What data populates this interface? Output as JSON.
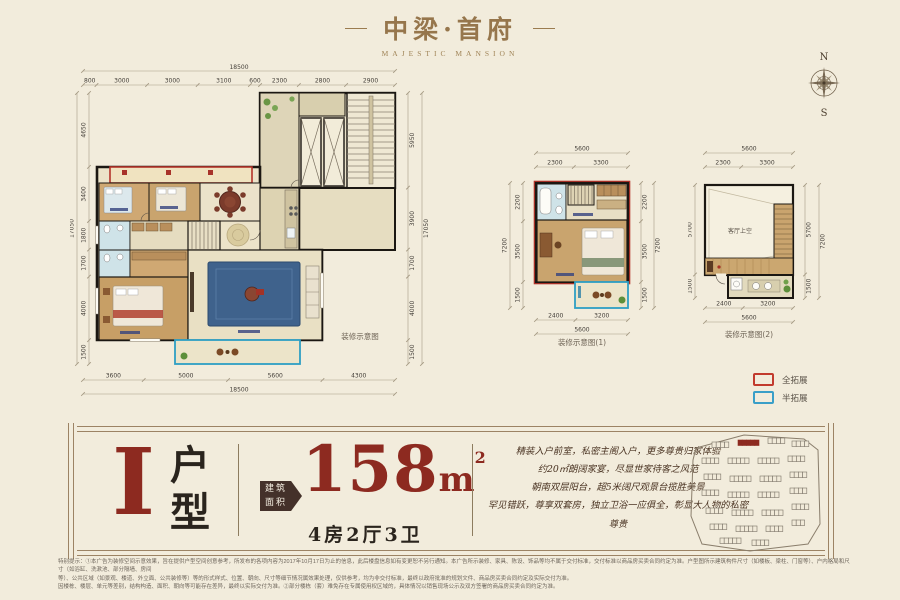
{
  "header": {
    "logo": "中梁·首府",
    "logo_sub": "MAJESTIC MANSION"
  },
  "compass": {
    "north": "N",
    "south": "S"
  },
  "main_plan": {
    "caption": "装修示意图",
    "dim_top_total": "18500",
    "dims_top": [
      "800",
      "3000",
      "3000",
      "3100",
      "600",
      "2300",
      "2800",
      "2900"
    ],
    "dim_left_total": "17050",
    "dims_left": [
      "4650",
      "3400",
      "1800",
      "1700",
      "4000",
      "1500"
    ],
    "dims_right": [
      "5950",
      "3900",
      "1700",
      "4000",
      "1500"
    ],
    "dim_right_total": "17050",
    "dims_bottom": [
      "3600",
      "5000",
      "5600",
      "4300"
    ],
    "dim_bottom_total": "18500"
  },
  "plan1": {
    "caption": "装修示意图(1)",
    "dim_top_total": "5600",
    "dims_top": [
      "2300",
      "3300"
    ],
    "dim_left_total": "7200",
    "dims_left": [
      "2200",
      "3500",
      "1500"
    ],
    "dims_right": [
      "2200",
      "3500",
      "1500"
    ],
    "dim_right_total": "7200",
    "dims_bottom": [
      "2400",
      "3200"
    ],
    "dim_bottom_total": "5600"
  },
  "plan2": {
    "caption": "装修示意图(2)",
    "room_label": "客厅上空",
    "dim_top_total": "5600",
    "dims_top": [
      "2300",
      "3300"
    ],
    "dims_left": [
      "5700",
      "1500"
    ],
    "dims_right": [
      "5700",
      "1500"
    ],
    "dim_right_total": "7200",
    "dims_bottom": [
      "2400",
      "3200"
    ],
    "dim_bottom_total": "5600"
  },
  "legend": {
    "full_label": "全拓展",
    "full_color": "#c23b2e",
    "half_label": "半拓展",
    "half_color": "#3a9fc8"
  },
  "banner": {
    "unit_letter": "I",
    "unit_word_top": "户",
    "unit_word_bottom": "型",
    "area_tag_line1": "建筑",
    "area_tag_line2": "面积",
    "area_value": "158",
    "area_unit": "m",
    "area_sup": "2",
    "layout_text": "4房2厅3卫",
    "desc_lines": [
      "精装入户前室，私密主阁入户，更多尊贵归家体验",
      "约20㎡朗阔家宴，尽显世家待客之风范",
      "朝南双层阳台，超5米阔尺观景台揽胜美景",
      "罕见错跃，尊享双套房，独立卫浴一应俱全，彰显大人物的私密尊贵"
    ]
  },
  "disclaimer": {
    "lines": [
      "特别提示：①本广告为装修空间示意效果，旨在提供户型空间创意参考，所发布的各项内容为2017年10月17日为止的信息，此后楼盘信息如有变更恕不另行通知。本广告所示装修、家具、陈设、饰品等均不属于交付标准，交付标准以商品房买卖合同约定为准。户型图所示建筑构件尺寸（如楼板、梁柱、门窗等）、户内格局和尺寸（如浴缸、洗漱池、部分隔墙、房间",
      "等）、公共区域（如景观、楼道、外立面、公共装修等）等的形式样式、位置、朝向、尺寸等细节情况属效果处理，仅供参考，均为非交付标准，最终以政府批准的规划文件、商品房买卖合同约定及实际交付为准。",
      "因楼栋、楼层、单元等差别，结构构造、面积、朝向等可能存在差异，最终以实际交付为准。②部分楼栋（套）难免存在专属使用权区域的，具体情况以销售现场公示及双方签署的商品房买卖合同约定为准。"
    ]
  }
}
